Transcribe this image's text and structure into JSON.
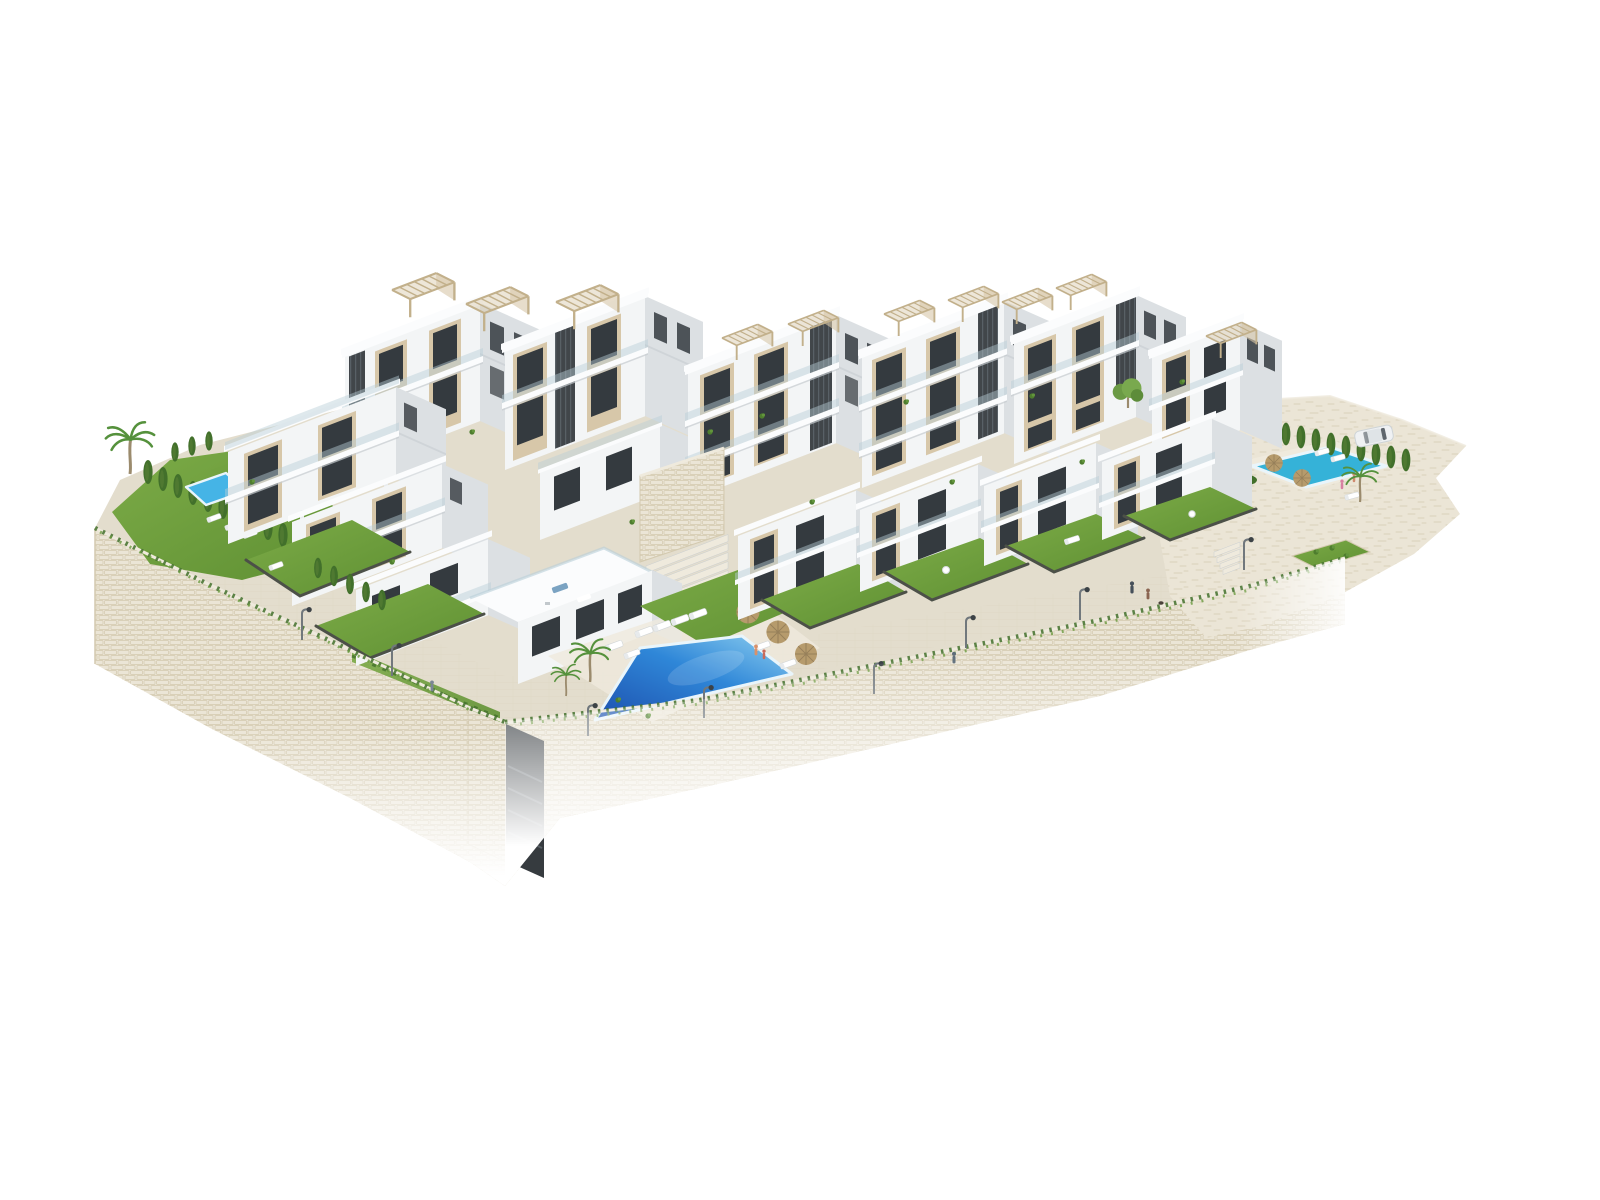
{
  "meta": {
    "title": "Aerial render of hillside apartment complex",
    "type": "architectural-3d-render",
    "background": "#ffffff",
    "description": "Aerial axonometric 3D rendering of a modern white Mediterranean apartment complex built over curved terraced stone retaining walls. White stepped buildings with beige accent panels, dark vertical louvers, glass balconies and rooftop slatted pergolas. Landscaped gardens with lawns, palm trees and cypress hedges, a large central trapezoidal swimming pool with sun loungers and straw parasols, a small private pool on the left garden, a second community pool on the rocky right terrace with a parked white car, a stone paved promenade with street lamps and tiny human figures, all on a plain white background."
  },
  "palette": {
    "white0": "#fbfcfd",
    "white1": "#f3f5f6",
    "white2": "#e8ebed",
    "shade1": "#dce0e3",
    "shade2": "#c6ccd0",
    "beige": "#d7c7a9",
    "beige2": "#c2b08b",
    "louver": "#41464a",
    "win": "#343a3f",
    "winlt": "#9fb2bb",
    "glass": "#b9cfd8",
    "grass": "#7cab47",
    "grass2": "#5f9033",
    "hedge": "#42702b",
    "stone": "#ebe5d6",
    "stonedk": "#d3c9af",
    "pav": "#e3ddcd",
    "pavlt": "#efeadd",
    "fence": "#4c5048",
    "pooldeep": "#1d50ae",
    "poolmain": "#2f87d8",
    "poollight": "#8fd0f0",
    "poolright": "#35b2d8",
    "poolleft": "#45b4e6",
    "poolrim": "#e9f5fb",
    "straw": "#b69b6c",
    "strawdk": "#97805a",
    "trunk": "#9b8b6d",
    "metal": "#70777c",
    "carbody": "#eff1f3"
  },
  "scene": {
    "buildings": {
      "count": 12,
      "floors_min": 2,
      "floors_max": 4,
      "features": [
        "white facades",
        "beige accent panels",
        "dark vertical louvers",
        "glass balcony railings",
        "rooftop slatted pergolas",
        "roof terraces with furniture",
        "stepped terraced massing"
      ]
    },
    "pools": [
      {
        "id": "left-private-pool",
        "shape": "small rectangle",
        "water": "#45b4e6"
      },
      {
        "id": "central-community-pool",
        "shape": "large trapezoid",
        "water": "#2f87d8",
        "props": [
          "sun loungers",
          "straw parasols",
          "bathers"
        ]
      },
      {
        "id": "right-community-pool",
        "shape": "rounded rectangle",
        "water": "#35b2d8",
        "props": [
          "straw parasols",
          "sun loungers",
          "bathers"
        ]
      }
    ],
    "vegetation": [
      "palm trees",
      "cypress hedges",
      "leafy trees",
      "lawn gardens",
      "potted balcony plants",
      "flowering shrub"
    ],
    "terrain": [
      "curved stone retaining walls",
      "stone paved promenade",
      "rocky beige terrace",
      "wide access stairs",
      "stair recess in wall"
    ],
    "props": [
      "street lamps",
      "white parked car",
      "outdoor dining sets",
      "tiny human figures",
      "dog"
    ]
  }
}
